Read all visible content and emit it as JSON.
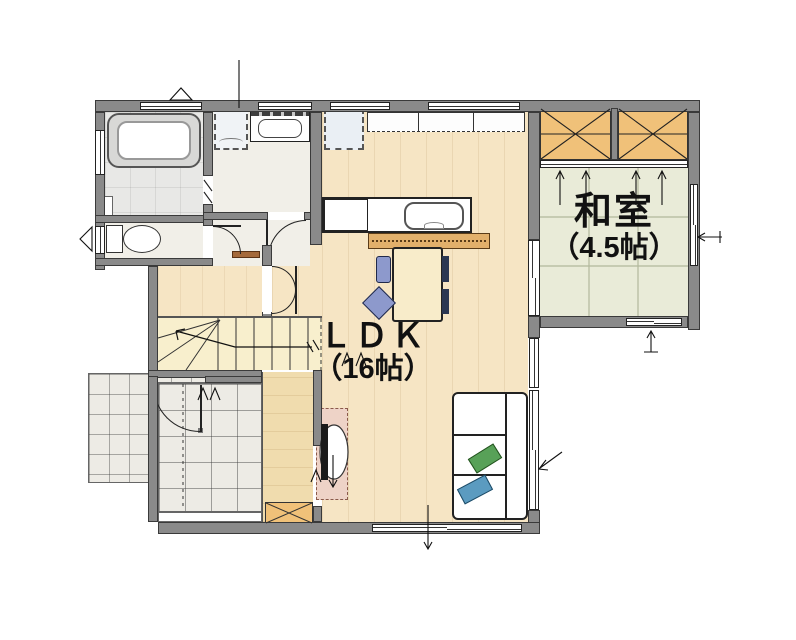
{
  "rooms": {
    "ldk": {
      "name": "ＬＤＫ",
      "size": "（16帖）"
    },
    "washitsu": {
      "name": "和室",
      "size": "（4.5帖）"
    }
  },
  "colors": {
    "wall": "#8a8a8a",
    "wallline": "#3a3a3a",
    "wood": "#f6e5c4",
    "strip": "#f0dcae",
    "pale": "#f1efe8",
    "bathf": "#e8e8e6",
    "stairf": "#f8efcd",
    "tatami": "#e9ebd8",
    "tile": "#edebe5",
    "closet": "#f0c179",
    "bar": "#e2b06b",
    "mat": "#eed3c7",
    "sofa_green": "#58a158",
    "sofa_blue": "#5b9bc0",
    "chair_blue": "#8d99cc",
    "table": "#f8ecca",
    "sill": "#a4693a"
  }
}
